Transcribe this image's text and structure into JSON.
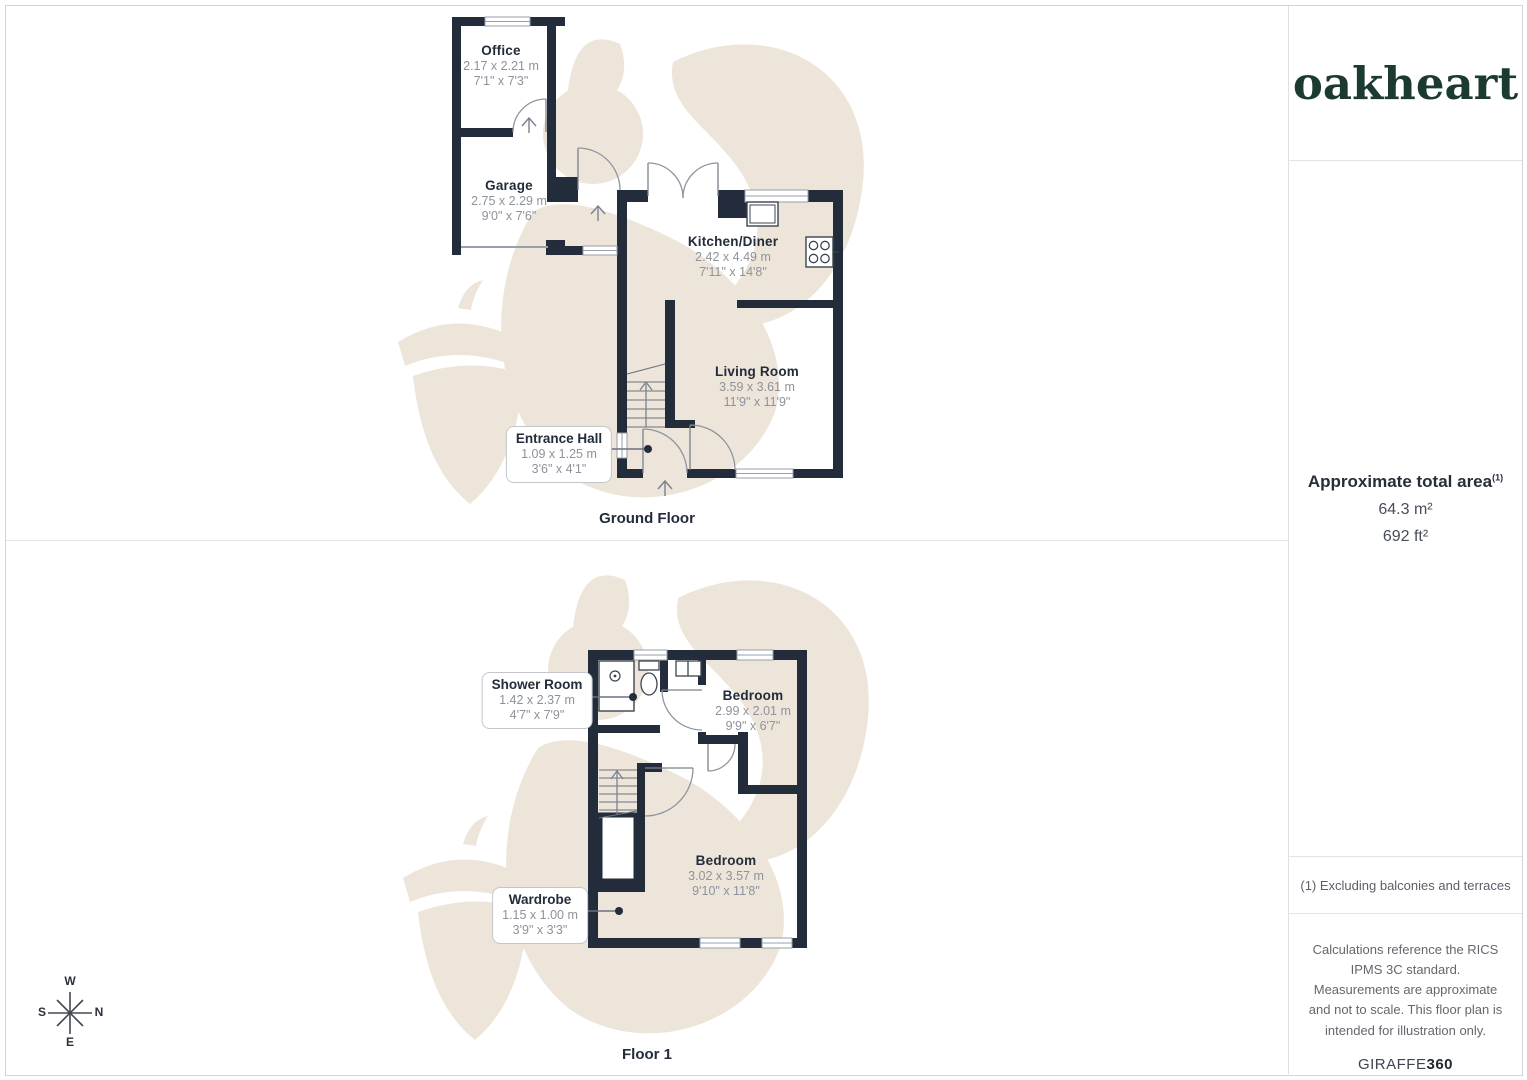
{
  "branding": {
    "logo_text": "oakheart",
    "giraffe": "GIRAFFE",
    "giraffe_bold": "360"
  },
  "sidebar": {
    "area_title": "Approximate total area",
    "area_sup": "(1)",
    "area_m2": "64.3 m²",
    "area_ft2": "692 ft²",
    "footnote": "(1) Excluding balconies and terraces",
    "disclaimer": "Calculations reference the RICS IPMS 3C standard. Measurements are approximate and not to scale. This floor plan is intended for illustration only."
  },
  "floors": {
    "ground": {
      "label": "Ground Floor",
      "rooms": {
        "office": {
          "name": "Office",
          "metric": "2.17 x 2.21 m",
          "imperial": "7'1\" x 7'3\""
        },
        "garage": {
          "name": "Garage",
          "metric": "2.75 x 2.29 m",
          "imperial": "9'0\" x 7'6\""
        },
        "kitchen": {
          "name": "Kitchen/Diner",
          "metric": "2.42 x 4.49 m",
          "imperial": "7'11\" x 14'8\""
        },
        "living": {
          "name": "Living Room",
          "metric": "3.59 x 3.61 m",
          "imperial": "11'9\" x 11'9\""
        },
        "entrance": {
          "name": "Entrance Hall",
          "metric": "1.09 x 1.25 m",
          "imperial": "3'6\" x 4'1\""
        }
      }
    },
    "first": {
      "label": "Floor 1",
      "rooms": {
        "shower": {
          "name": "Shower Room",
          "metric": "1.42 x 2.37 m",
          "imperial": "4'7\" x 7'9\""
        },
        "bedroom1": {
          "name": "Bedroom",
          "metric": "2.99 x 2.01 m",
          "imperial": "9'9\" x 6'7\""
        },
        "bedroom2": {
          "name": "Bedroom",
          "metric": "3.02 x 3.57 m",
          "imperial": "9'10\" x 11'8\""
        },
        "wardrobe": {
          "name": "Wardrobe",
          "metric": "1.15 x 1.00 m",
          "imperial": "3'9\" x 3'3\""
        }
      }
    }
  },
  "compass": {
    "top": "W",
    "right": "N",
    "left": "S",
    "bottom": "E"
  },
  "colors": {
    "wall": "#232c3a",
    "watermark": "#ede5da",
    "dim_text": "#8d929b",
    "accent_green": "#1b3a31"
  }
}
